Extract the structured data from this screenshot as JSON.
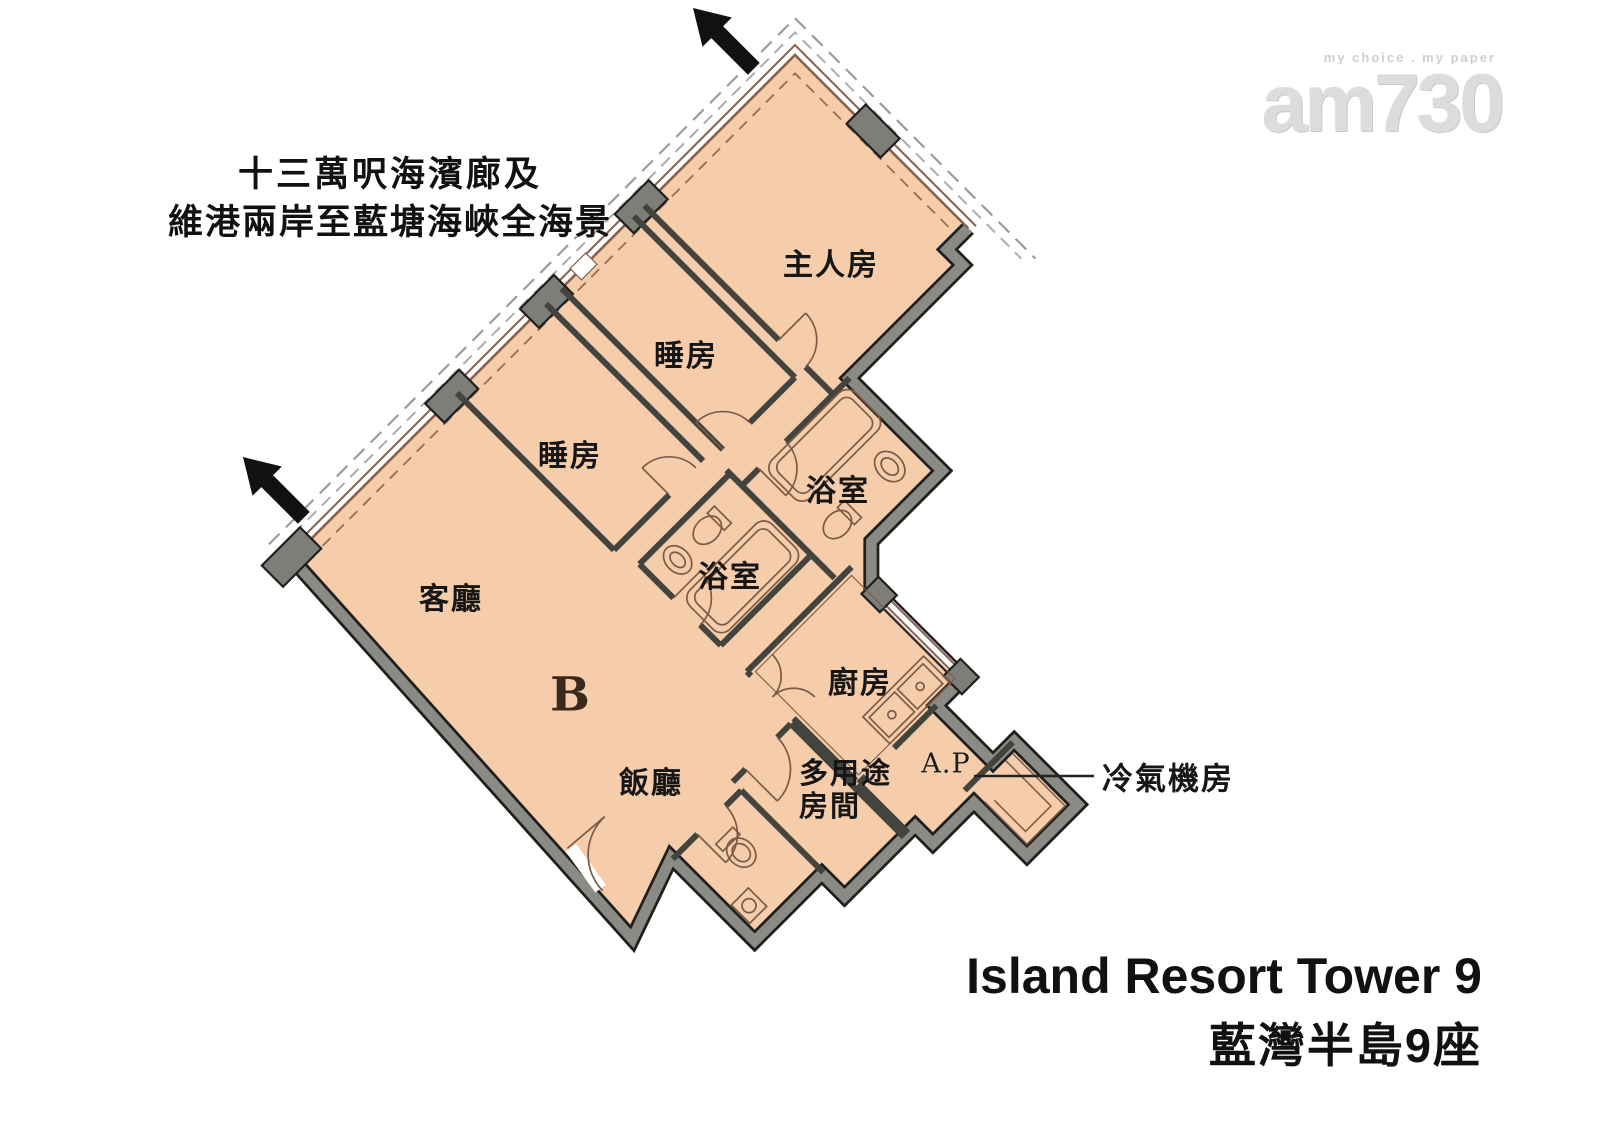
{
  "header": {
    "line1": "十三萬呎海濱廊及",
    "line2": "維港兩岸至藍塘海峽全海景"
  },
  "logo": {
    "tagline": "my choice . my paper",
    "brand": "am730"
  },
  "rooms": {
    "master": "主人房",
    "bedroom_upper": "睡房",
    "bedroom_lower": "睡房",
    "bath_upper": "浴室",
    "bath_lower": "浴室",
    "living": "客廳",
    "dining": "飯廳",
    "kitchen": "廚房",
    "multipurpose_line1": "多用途",
    "multipurpose_line2": "房間",
    "ap": "A.P",
    "unit_letter": "B"
  },
  "callout": {
    "ac_room": "冷氣機房"
  },
  "footer": {
    "line1": "Island Resort Tower 9",
    "line2": "藍灣半島9座"
  },
  "colors": {
    "floor": "#f5cdab",
    "wall_gray": "#8b8b85",
    "wall_outline": "#1f1f1f",
    "column": "#7e7e78",
    "partition": "#44443f",
    "window_line": "#8a5f4c",
    "dashed_line": "#9c9c97",
    "arrow": "#111111"
  }
}
